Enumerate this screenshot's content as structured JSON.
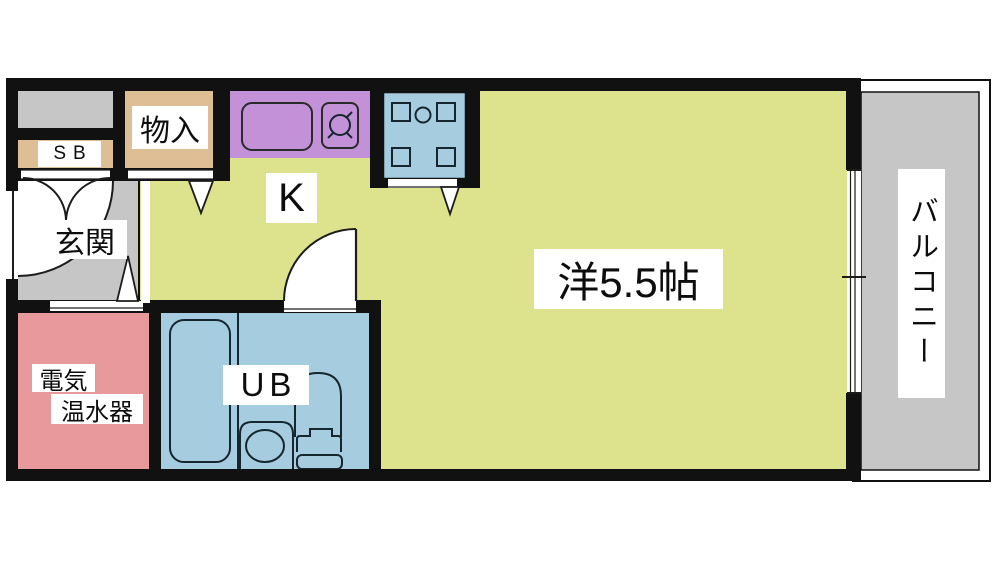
{
  "plan_type": "apartment-floorplan",
  "labels": {
    "shoe_box": "SB",
    "storage": "物入",
    "kitchen": "K",
    "entrance": "玄関",
    "main_room": "洋5.5帖",
    "unit_bath": "UB",
    "water_heater_line1": "電気",
    "water_heater_line2": "温水器",
    "balcony": "バルコニー"
  },
  "colors": {
    "room-yellow": "#dde28c",
    "counter-purple": "#c291d8",
    "water-blue": "#a6cddf",
    "heater-pink": "#e8999b",
    "closet-tan": "#debe94",
    "floor-gray": "#c6c6c6",
    "wall-black": "#111111",
    "fixture-line": "#16262e"
  }
}
